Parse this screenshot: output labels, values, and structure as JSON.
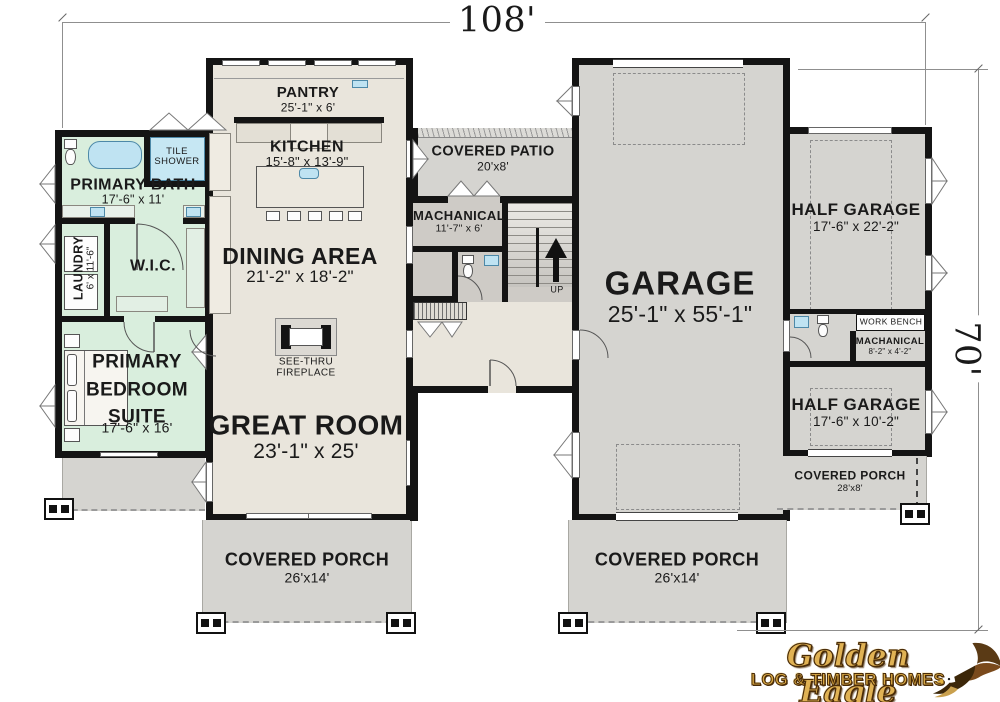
{
  "dimensions": {
    "width_label": "108'",
    "height_label": "70'"
  },
  "rooms": {
    "pantry": {
      "name": "PANTRY",
      "dims": "25'-1\" x 6'"
    },
    "kitchen": {
      "name": "KITCHEN",
      "dims": "15'-8\" x 13'-9\""
    },
    "dining_area": {
      "name": "DINING AREA",
      "dims": "21'-2\" x 18'-2\""
    },
    "great_room": {
      "name": "GREAT ROOM",
      "dims": "23'-1\" x 25'"
    },
    "primary_bath": {
      "name": "PRIMARY BATH",
      "dims": "17'-6\" x 11'"
    },
    "tile_shower": {
      "name": "TILE SHOWER"
    },
    "laundry": {
      "name": "LAUNDRY",
      "dims": "6' x 11'-6\""
    },
    "wic": {
      "name": "W.I.C."
    },
    "primary_bedroom": {
      "name": "PRIMARY BEDROOM SUITE",
      "dims": "17'-6\" x 16'"
    },
    "covered_patio": {
      "name": "COVERED PATIO",
      "dims": "20'x8'"
    },
    "mechanical_main": {
      "name": "MACHANICAL",
      "dims": "11'-7\" x 6'"
    },
    "garage": {
      "name": "GARAGE",
      "dims": "25'-1\" x 55'-1\""
    },
    "half_garage_upper": {
      "name": "HALF GARAGE",
      "dims": "17'-6\" x 22'-2\""
    },
    "half_garage_lower": {
      "name": "HALF GARAGE",
      "dims": "17'-6\" x 10'-2\""
    },
    "work_bench": {
      "name": "WORK BENCH"
    },
    "mechanical_small": {
      "name": "MACHANICAL",
      "dims": "8'-2\" x 4'-2\""
    },
    "covered_porch_side": {
      "name": "COVERED PORCH",
      "dims": "28'x8'"
    },
    "covered_porch_left": {
      "name": "COVERED PORCH",
      "dims": "26'x14'"
    },
    "covered_porch_right": {
      "name": "COVERED PORCH",
      "dims": "26'x14'"
    },
    "fireplace": {
      "name": "SEE-THRU FIREPLACE"
    },
    "stairs": {
      "up": "UP"
    }
  },
  "logo": {
    "brand": "Golden Eagle",
    "tagline": "LOG & TIMBER HOMES"
  },
  "colors": {
    "wall": "#141414",
    "suite_green": "#d9eedd",
    "living_beige": "#e9e5dc",
    "garage_gray": "#d5d4d0",
    "service_gray": "#cecbc6",
    "water_blue": "#bfe3f2",
    "logo_gold": "#d9a843",
    "logo_brown": "#4a2c08"
  }
}
